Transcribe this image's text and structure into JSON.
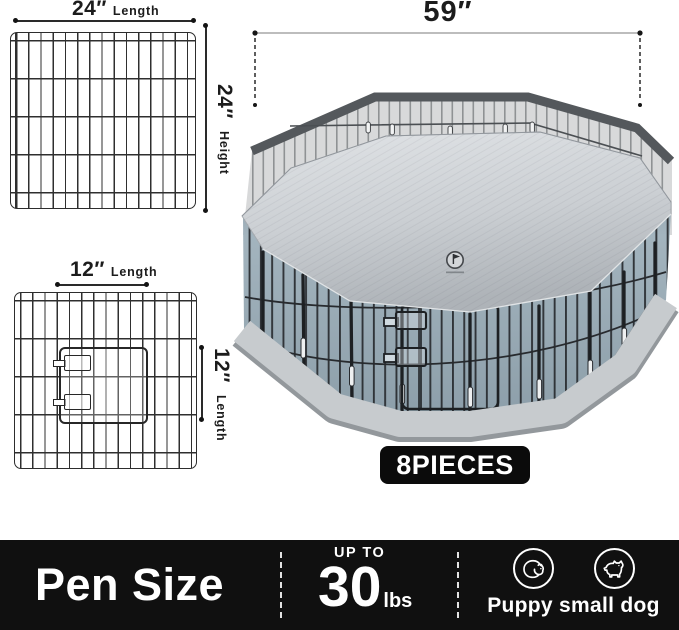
{
  "panel_24": {
    "length_value": "24″",
    "length_label": "Length",
    "height_value": "24″",
    "height_label": "Height"
  },
  "panel_12": {
    "length_value": "12″",
    "length_label": "Length",
    "door_side_value": "12″",
    "door_side_label": "Length"
  },
  "pen_diagram": {
    "width_value": "59″",
    "pieces_badge": "8PIECES"
  },
  "bottom_bar": {
    "title": "Pen Size",
    "weight": {
      "prefix": "UP TO",
      "value": "30",
      "unit": "lbs"
    },
    "dog_types_label": "Puppy small dog",
    "icons": [
      "puppy-icon",
      "small-dog-icon"
    ]
  },
  "colors": {
    "bar_background": "#101010",
    "badge_background": "#0b0b0b",
    "cover_gray": "#cbcfd3",
    "mat_blue_gray": "#a3b4be",
    "wire_black": "#272a2e",
    "dimension_text": "#1c1c1c"
  }
}
